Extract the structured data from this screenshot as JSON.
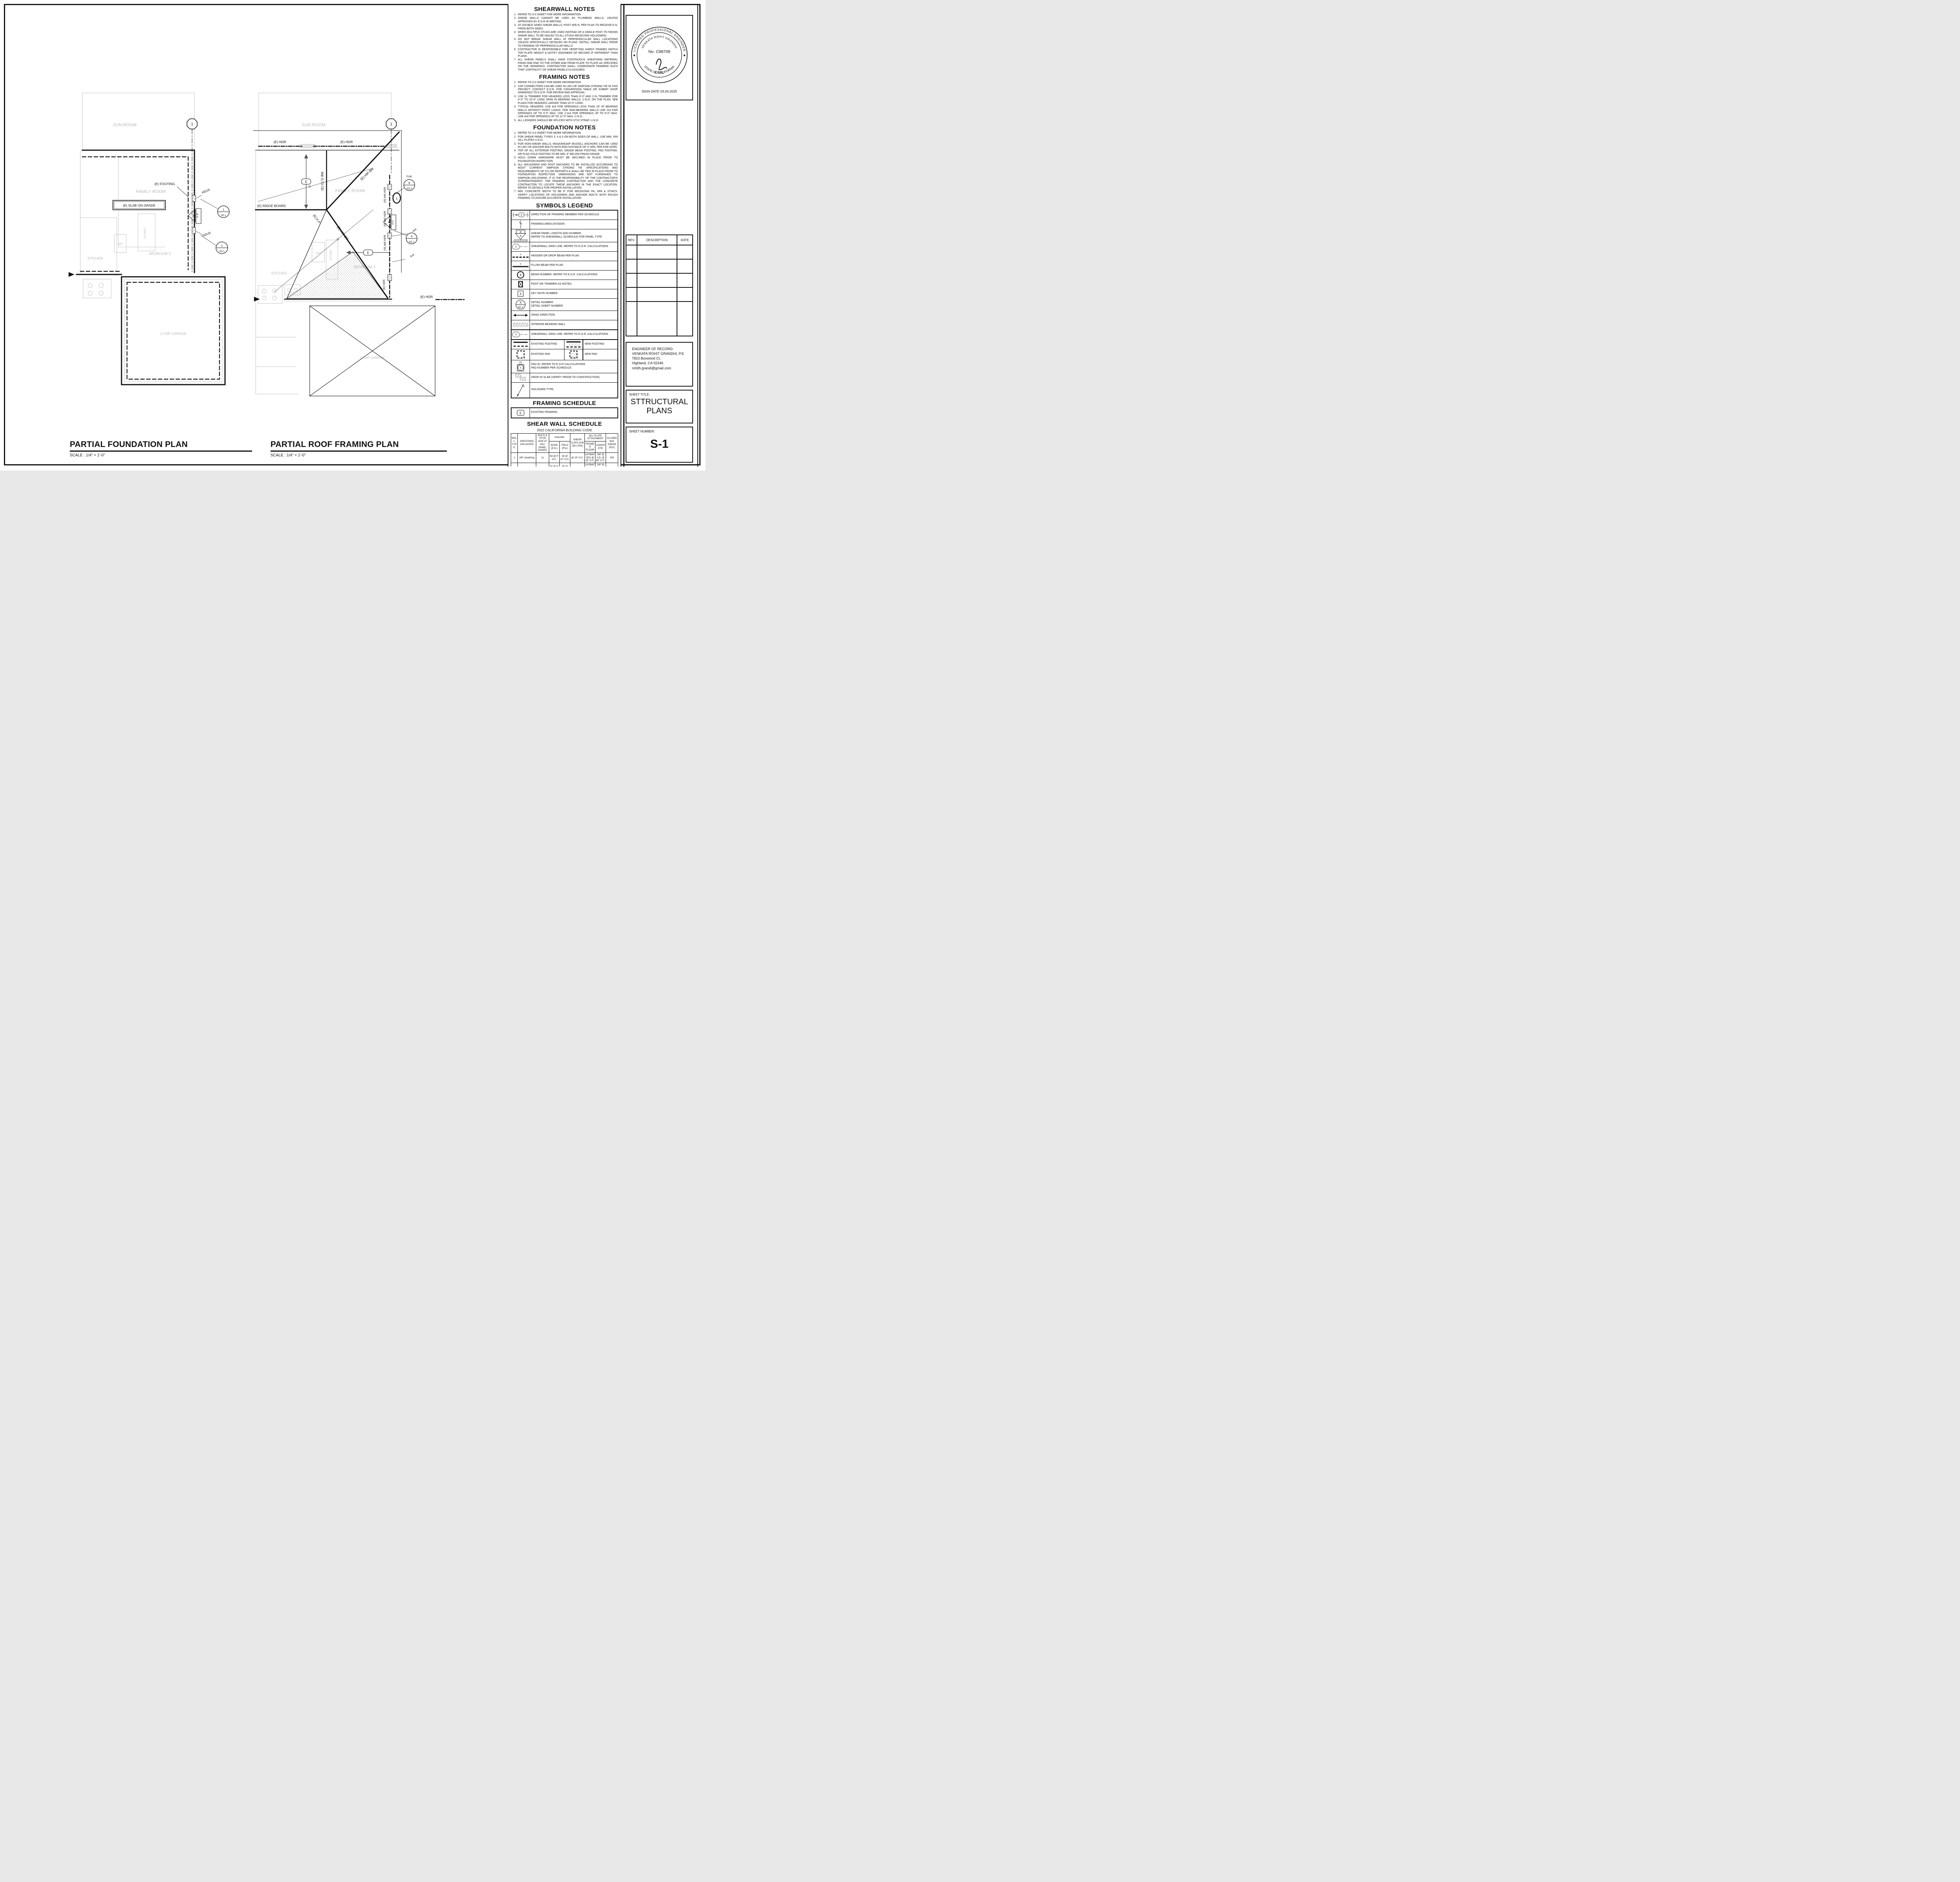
{
  "sheet": {
    "number": "S-1"
  },
  "plan_titles": {
    "foundation": {
      "title": "PARTIAL FOUNDATION PLAN",
      "scale": "SCALE : 1/4\" = 1'-0\""
    },
    "roof": {
      "title": "PARTIAL ROOF FRAMING PLAN",
      "scale": "SCALE : 1/4\" = 1'-0\""
    }
  },
  "foundation_plan": {
    "rooms": {
      "sun_room": "SUN ROOM",
      "family_room": "FAMILY ROOM",
      "kitchen": "KITCHEN",
      "closet": "CLOSET",
      "ref": "REF",
      "dw": "DW",
      "bedroom": "BEDROOM 3",
      "garage": "2 CAR GARAGE"
    },
    "labels": {
      "footing": "(E) FOOTING",
      "slab": "(E) SLAB ON GRADE",
      "holdown1": "HDU5",
      "holdown2": "HDU5",
      "panel_num": "3",
      "panel_len": "4'-0\""
    },
    "grid_bubble": "1",
    "detail1": {
      "num": "1",
      "sheet": "SD.1"
    },
    "detail2": {
      "num": "2",
      "sheet": "SD.1"
    }
  },
  "roof_plan": {
    "rooms": {
      "sun_room": "SUN ROOM",
      "family_room": "FAMILY ROOM",
      "kitchen": "KITCHEN",
      "closet": "CLOSET",
      "ref": "REF",
      "dw": "DW",
      "bedroom": "BEDROOM 3",
      "garage": "2 CAR GARAGE"
    },
    "labels": {
      "hdr1": "(E) HDR",
      "hdr2": "(E) HDR",
      "hdr3": "(E) HDR",
      "hdr4": "(E) HDR",
      "ridge": "(E) RIDGE BOARD",
      "hip1": "(E) HIP BM",
      "hip2": "(E) HIP BM",
      "clg": "(E) CL'G BM",
      "kp": "(E) K.P.",
      "nhdr": "(N) 4x6 HDR",
      "typ": "TYP.",
      "e": "E",
      "p44": "4x4",
      "panel_num": "3",
      "panel_len": "4'-0\""
    },
    "grid_bubble": "1",
    "sw_bubble": "1",
    "detail_typ": {
      "num": "8",
      "sheet": "SD.0"
    },
    "detail4": {
      "num": "4",
      "sheet": "SD.1"
    }
  },
  "shearwall_notes": {
    "title": "SHEARWALL NOTES",
    "items": [
      "REFER TO S-0 SHEET FOR MORE INFORMATION.",
      "SHEAR WALLS CANNOT BE USED AS PLUMBING WALLS, UNLESS APPROVED BY E.O.R IN WRITING.",
      "AT DOUBLE SIDED SHEAR WALLS, POST W/E.N. PER PLAN TO RECEIVE E.N. FROM BOTH SIDES.",
      "WHEN MULTIPLE STUDS ARE USED INSTEAD OF A SINGLE POST, PLYWOOD SHEAR WALL TO BE NAILED TO ALL STUDS RECEIVING HOLDOWNS.",
      "DO NOT BREAK SHEAR WALL AT PERPENDICULAR WALL LOCATIONS UNLESS SPECIFICALLY DETAILED ON PLANS. INSTALL SHEAR WALL PRIOR TO FRAMING OF PERPENDICULAR WALLS.",
      "CONTRACTOR IS RESPONSIBLE FOR VERIFYING HARDY FRAMES MATCH TOP PLATE HEIGHT & NOTIFY ENGINEER OF RECORD IF DIFFERENT THAN PLANS.",
      "ALL SHEAR PANELS SHALL HAVE CONTINUOUS SHEATHING MATERIAL FROM ONE END TO THE OTHER AND FROM PLATE TO PLATE AS SPECIFIED ON THE DRAWINGS. CONTRACTOR SHALL COORDINATE FRAMING SUCH THAT CONTINUITY OF SHEAR PANELS IS ASSURED."
    ]
  },
  "framing_notes": {
    "title": "FRAMING NOTES",
    "items": [
      "REFER TO S-0 SHEET FOR MORE INFORMATION.",
      "USP CONNECTORS CAN BE USED IN LIEU OF SIMPSON STRONG TIE IN THIS PROJECT. CONTACT E.O.R. FOR CONVERSION TABLE OR SUBMIT SHOP DRAWINGS TO E.O.R. FOR REVIEW AND APPROVAL.",
      "USE 2x TRIMMER FOR HEADERS LESS THAN 6'-0\" AND 2-2x TRIMMER FOR 6'-0\" TO 10'-0\" LONG SPAN IN BEARING WALLS, U.N.O. ON THE PLAN. SEE PLANS FOR HEADERS LARGER THAN 10'-0\" LONG.",
      "TYPICAL HEADERS: USE 4x4 FOR OPENINGS LESS THAN 16\" AT BEARING WALLS WITHOUT POINT LOADS. FOR NON-BEARING WALLS USE 2x4 FOR OPENINGS UP TO 3'-0\" MAX. USE 2-2x4 FOR OPENINGS UP TO 6'-0\" MAX. USE 4x6 FOR OPENINGS UP TO 12'-0\" MAX. U.N.O.",
      "ALL LEDGERS SHOULD BE SPLICED WITH ST22 STRAP, U.N.O."
    ]
  },
  "foundation_notes": {
    "title": "FOUNDATION NOTES",
    "items": [
      "REFER TO S-0 SHEET FOR MORE INFORMATION.",
      "FOR SHEAR PANEL TYPES 3, 4 & 5 ON BOTH SIDES OF WALL, USE MIN. 3X6 SILL PLATES U.N.O.",
      "FOR NON-SHEAR WALLS, MASA/MASAP MUDSILL ANCHORS CAN BE USED IN LIEU OF ANCHOR BOLTS WITH END DISTANCE OF 4\" MIN. PER  ESR #2555.",
      "TOP OF ALL EXTERIOR FOOTING, GRADE BEAM FOOTING, PAD FOOTING, OR FLAG POLE FOOTING TO BE MIN. 6\" BELOW FINISH GRADE.",
      "HOLD DOWN HARDWARE MUST BE SECURED IN PLACE PRIOR TO FOUNDATION INSPECTION",
      "ALL HOLDOWNS AND POST ANCHORS TO BE INSTALLED ACCORDING TO MOST CURRENT SIMPSON STRONG TIE SPECIFICATIONS AND REQUIREMENTS OF ICC-ER REPORTS & SHALL BE TIED IN PLACE PRIOR TO FOUNDATION INSPECTION. DIMENSIONS ARE NOT FURNISHED TO SIMPSON HOLDOWNS. IT IS THE RESPONSIBILITY OF  THE CONTRACTOR'S SUPERINTENDENT, THE FRAMING CONTRACTOR AND THE CONCRETE CONTRACTOR TO LOCATE THESE ANCHORS IN THE EXACT LOCATION. REFER TO DETAILS FOR PROPER INSTALLATION.",
      "MIN. CONCRETE WIDTH TO BE 8\" FOR RECEIVING PA, HPA & STHD'S. VERIFY LOCATIONS OF HOLDOWNS AND ANCHOR BOLTS WITH ROUGH FRAMING TO ASSURE ACCURATE INSTALLATION."
    ]
  },
  "symbols_legend": {
    "title": "SYMBOLS LEGEND",
    "sym": {
      "x": "X",
      "sdx": "SD.X",
      "hx": "#X",
      "e": "E"
    },
    "rows": [
      {
        "label": "DIRECTION OF FRAMING MEMBER PER SCHEDULE"
      },
      {
        "label": "FRAMING AREA DIVISION"
      },
      {
        "label": "SHEAR PANEL LENGTH AND NUMBER.\nREFER TO SHEARWALL SCHEDULE FOR PANEL TYPE"
      },
      {
        "label": "SHEARWALL GRID LINE, REFER TO E.O.R. CALCULATIONS"
      },
      {
        "label": "HEADER OR DROP BEAM PER PLAN"
      },
      {
        "label": "FLUSH BEAM PER PLAN"
      },
      {
        "label": "BEAM NUMBER, REFER TO E.O.R. CALCULATIONS"
      },
      {
        "label": "POST OR TRIMMER AS NOTED"
      },
      {
        "label": "KEY NOTE NUMBER"
      },
      {
        "label": "DETAIL NUMBER\nDETAIL SHEET NUMBER"
      },
      {
        "label": "DRAG DIRECTION"
      },
      {
        "label": "INTERIOR BEARING WALL"
      },
      {
        "label": "SHEARWALL GRID LINE, REFER TO E.O.R. CALCULATIONS"
      },
      {
        "label": "EXISTING FOOTING",
        "label2": "NEW FOOTING"
      },
      {
        "label": "EXISTING PAD",
        "label2": "NEW PAD"
      },
      {
        "label": "PAD ID, REFER TO E.O.R CALCULATIONS\nPAD NUMBER PER SCHEDULE"
      },
      {
        "label": "DROP IN SLAB (VERIFY PRIOR TO CONSTRUCTION)"
      },
      {
        "label": "HOLDOWN TYPE,"
      }
    ]
  },
  "framing_schedule": {
    "title": "FRAMING SCHEDULE",
    "symbol": "E",
    "label": "EXISTING FRAMING"
  },
  "shear_wall_schedule": {
    "title": "SHEAR WALL SCHEDULE",
    "subtitle": "2022 CALIFORNIA BUILDING CODE",
    "head": {
      "wall_type": "WALL TYPE",
      "sheathing": "SHEATHING APA-RATED",
      "blkg": "BLK'G & STUD SIZE AT ADJ. PANEL EDGES",
      "nailing": "NAILING",
      "edge": "EDGE (E.N.)",
      "field": "FIELD (F.N.)",
      "clips": "SHEAR CLIPS (A35 OR LTP4)",
      "sill": "SILL PLATE ATTACHMENT",
      "framed": "FRAMED FLOOR",
      "concrete": "CONCRETE",
      "allow": "ALLOWABLE SHEAR (PLF)"
    },
    "rows": [
      {
        "cells": [
          "1",
          "3/8\" sheathing",
          "2x",
          "8d @ 6\" O.C.",
          "8d @ 12\" O.C.",
          "@ 24\" O.C.",
          "1/4\"Øx6\" SDS @ 16\" O.C.",
          "5/8\" Ø A.B. @ 48\" O.C.",
          "260"
        ]
      },
      {
        "cells": [
          "2",
          "3/8\" sheathing",
          "3x",
          "8d @ 4\" O.C.",
          "8d @ 12\" O.C.",
          "@ 16\" O.C.",
          "1/4\"Øx6\" SDS @ 12\" O.C.",
          "5/8\" Ø A.B. @ 42\" O.C.",
          "380"
        ]
      },
      {
        "cells": [
          "3",
          "3/8\" sheathing",
          "3x",
          "8d @ 3\" O.C.",
          "8d @ 12\" O.C.",
          "@ 8\" O.C.",
          "1/4\"Øx6\" SDS @ 8\" O.C.",
          "5/8\" Ø A.B. @ 36\" O.C.",
          "490"
        ]
      },
      {
        "cells": [
          "4",
          "3/8\" sheathing",
          "3x",
          "8d @ 2\" O.C.",
          "8d @ 12\" O.C.",
          "@ 8\" O.C.",
          "1/4\"Øx6\" SDS @ 6\" O.C.",
          "5/8\" Ø A.B. @ 24\" O.C.",
          "640"
        ]
      },
      {
        "cells": [
          "5",
          "15/32\" Struc. I",
          "3x",
          "10d @ 2\" O.C.",
          "10d @ 12\" O.C.",
          "@ 6\" O.C.",
          "1/4\"Øx6\" SDS @ 5\" O.C.",
          "5/8\" Ø A.B. @ 18\" O.C.",
          "870"
        ]
      },
      {
        "cells": [
          "3D",
          "3/8\" sheathing BOTH SIDES",
          "3x",
          "8d @ 3\" O.C.",
          "8d @ 12\" O.C.",
          "@ 4\" O.C.",
          "1/4\"Øx6\" SDS @ 4\" O.C.",
          "5/8\" Ø A.B. @ 18\" O.C.",
          "980"
        ]
      },
      {
        "cells": [
          "4D",
          "3/8\" sheathing BOTH SIDES",
          "3x",
          "8d @ 2\" O.C.",
          "8d @ 12\" O.C.",
          "@ 4\" O.C.",
          "1/4\"Øx6\" SDS @ 3\" O.C.",
          "5/8\" Ø A.B. @ 12\" O.C.",
          "1280"
        ]
      },
      {
        "cells": [
          "5D",
          "15/32\" Struc. I BOTH SIDES",
          "3x",
          "10d @ 2\" O.C.",
          "10d @ 12\" O.C.",
          "@ 3\" O.C.",
          "1/4\"Øx6\" SDS @ 2.5\" O.C.",
          "5/8\" Ø A.B. @ 9\" O.C.",
          "1740"
        ]
      }
    ],
    "notes_title": "NOTES:",
    "notes": [
      "(1)   PROVIDE STAGGERED NAILING AT ALL PANEL EDGES.",
      "(2)   STUDS ARE SPACED @ 16\" O.C. MAX., UNO."
    ]
  },
  "title_block": {
    "stamp": {
      "arc_top": "LICENSED PROFESSIONAL ENGINEER",
      "arc_name": "VENKATA ROHIT GRANDHI",
      "license": "No. C88709",
      "discipline": "CIVIL",
      "arc_bottom": "STATE OF CALIFORNIA",
      "star_left": "★",
      "star_right": "★"
    },
    "sign_date": "SIGN DATE  03.04.2025",
    "rev": {
      "headers": [
        "REV.",
        "DESCRIPTION",
        "DATE"
      ]
    },
    "eor_lines": [
      "ENGINEER OF RECORD:",
      "VENKATA ROHIT GRANDHI, P.E",
      "7823 Boxwood Ct,",
      "Highland,  CA 92346",
      "rohith.grandi@gmail.com"
    ],
    "sheet_title_label": "SHEET TITLE:",
    "sheet_title_line1": "STTRUCTURAL",
    "sheet_title_line2": "PLANS",
    "sheet_number_label": "SHEET NUMBER:",
    "sheet_number": "S-1"
  }
}
